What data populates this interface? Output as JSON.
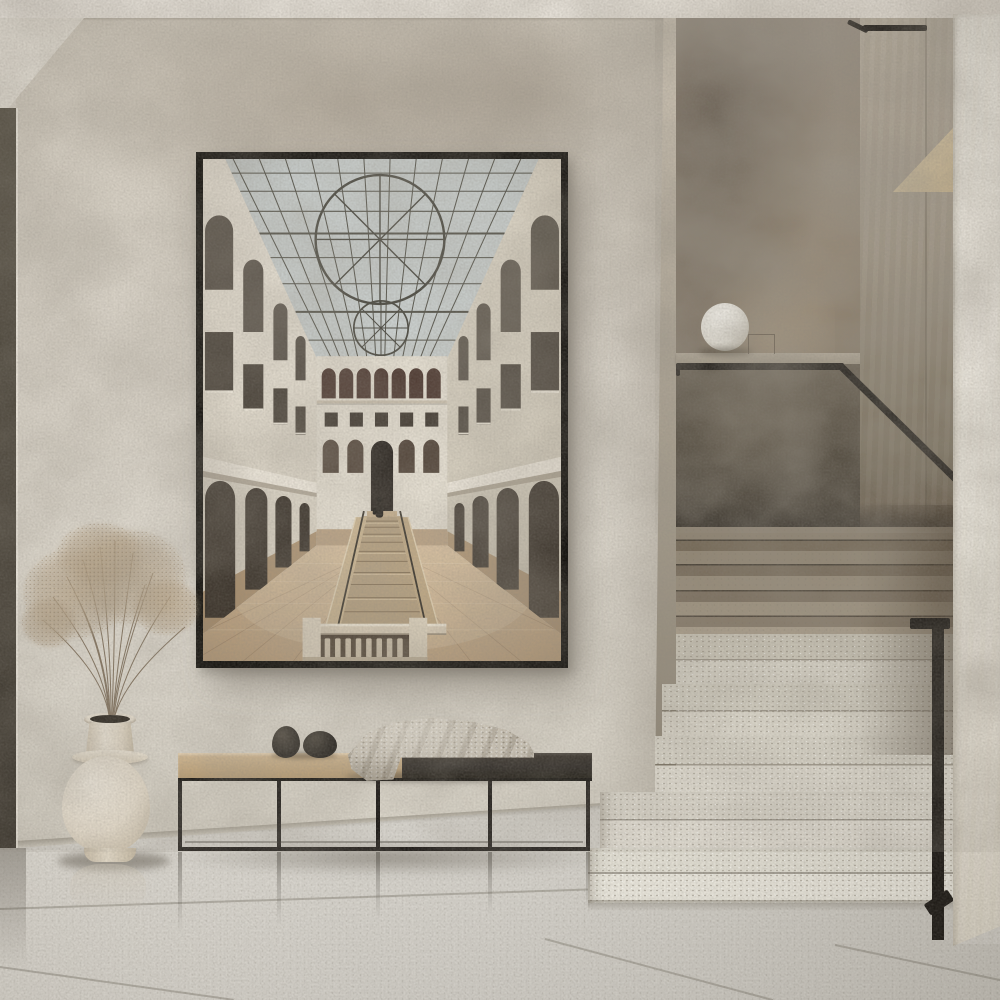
{
  "scene": {
    "description": "Minimalist beige hallway: large framed architectural photograph on a textured plaster wall, low black-steel bench with knit throw and pebble sculptures, cream floor vase with dried pampas grass, and a terrazzo staircase with a black handrail and globe lamp",
    "style": "warm minimalist interior photograph, soft daylight",
    "objects": {
      "artwork": {
        "label": "Framed photograph of a museum atrium",
        "frame_color": "#15130f",
        "subject": "Sunlit atrium with glass skylight and circular roof motif, triple-tier arched galleries, central stone staircase, stone balustrade, and a lone figure in dark clothing climbing the stairs"
      },
      "vase": {
        "label": "Cream ceramic floor vase",
        "color": "#ece4d5"
      },
      "pampas": {
        "label": "Dried pampas grass",
        "color": "#b3a084"
      },
      "bench": {
        "label": "Low bench, black steel frame, two-tone seat",
        "seat_left_color": "#c8ad85",
        "seat_right_color": "#2d2925",
        "frame_color": "#1e1b18"
      },
      "pebbles": {
        "label": "Two black pebble sculptures",
        "color": "#26231f"
      },
      "throw": {
        "label": "Chunky knit throw blanket",
        "color": "#d0c9bb"
      },
      "globe_lamp": {
        "label": "White globe lamp on stair ledge",
        "color": "#efede7"
      },
      "wire_stand": {
        "label": "Small wire stand beside the lamp"
      },
      "handrail": {
        "label": "Black metal handrail",
        "color": "#1d1a16"
      },
      "stairs_lower": {
        "label": "Light terrazzo steps",
        "color": "#e0dcd1"
      },
      "stairs_upper": {
        "label": "Shadowed terrazzo steps",
        "color": "#8b7f6d"
      },
      "stair_parapet": {
        "label": "Dark plaster stair parapet",
        "color": "#554d41"
      },
      "left_door": {
        "label": "Dark doorway frame at left edge",
        "color": "#4a443a"
      },
      "floor": {
        "label": "Polished stone tile floor",
        "color": "#d8d5ce"
      },
      "walls": {
        "label": "Textured limewash plaster walls",
        "color": "#d9d3c8"
      },
      "right_pillar": {
        "label": "Light plaster pillar",
        "color": "#eae6dc"
      }
    },
    "palette": {
      "ceiling": "#eae5dc",
      "wall": "#d9d3c8",
      "wall_mottle": "#a2957f",
      "floor": "#d8d5ce",
      "stairwell_back_wall": "#95897a",
      "artwork_sky": "#cbd1d0",
      "artwork_wall": "#e8e2d5",
      "artwork_stone_floor": "#c8ad8b",
      "artwork_arch_dark": "#3d362e"
    }
  }
}
